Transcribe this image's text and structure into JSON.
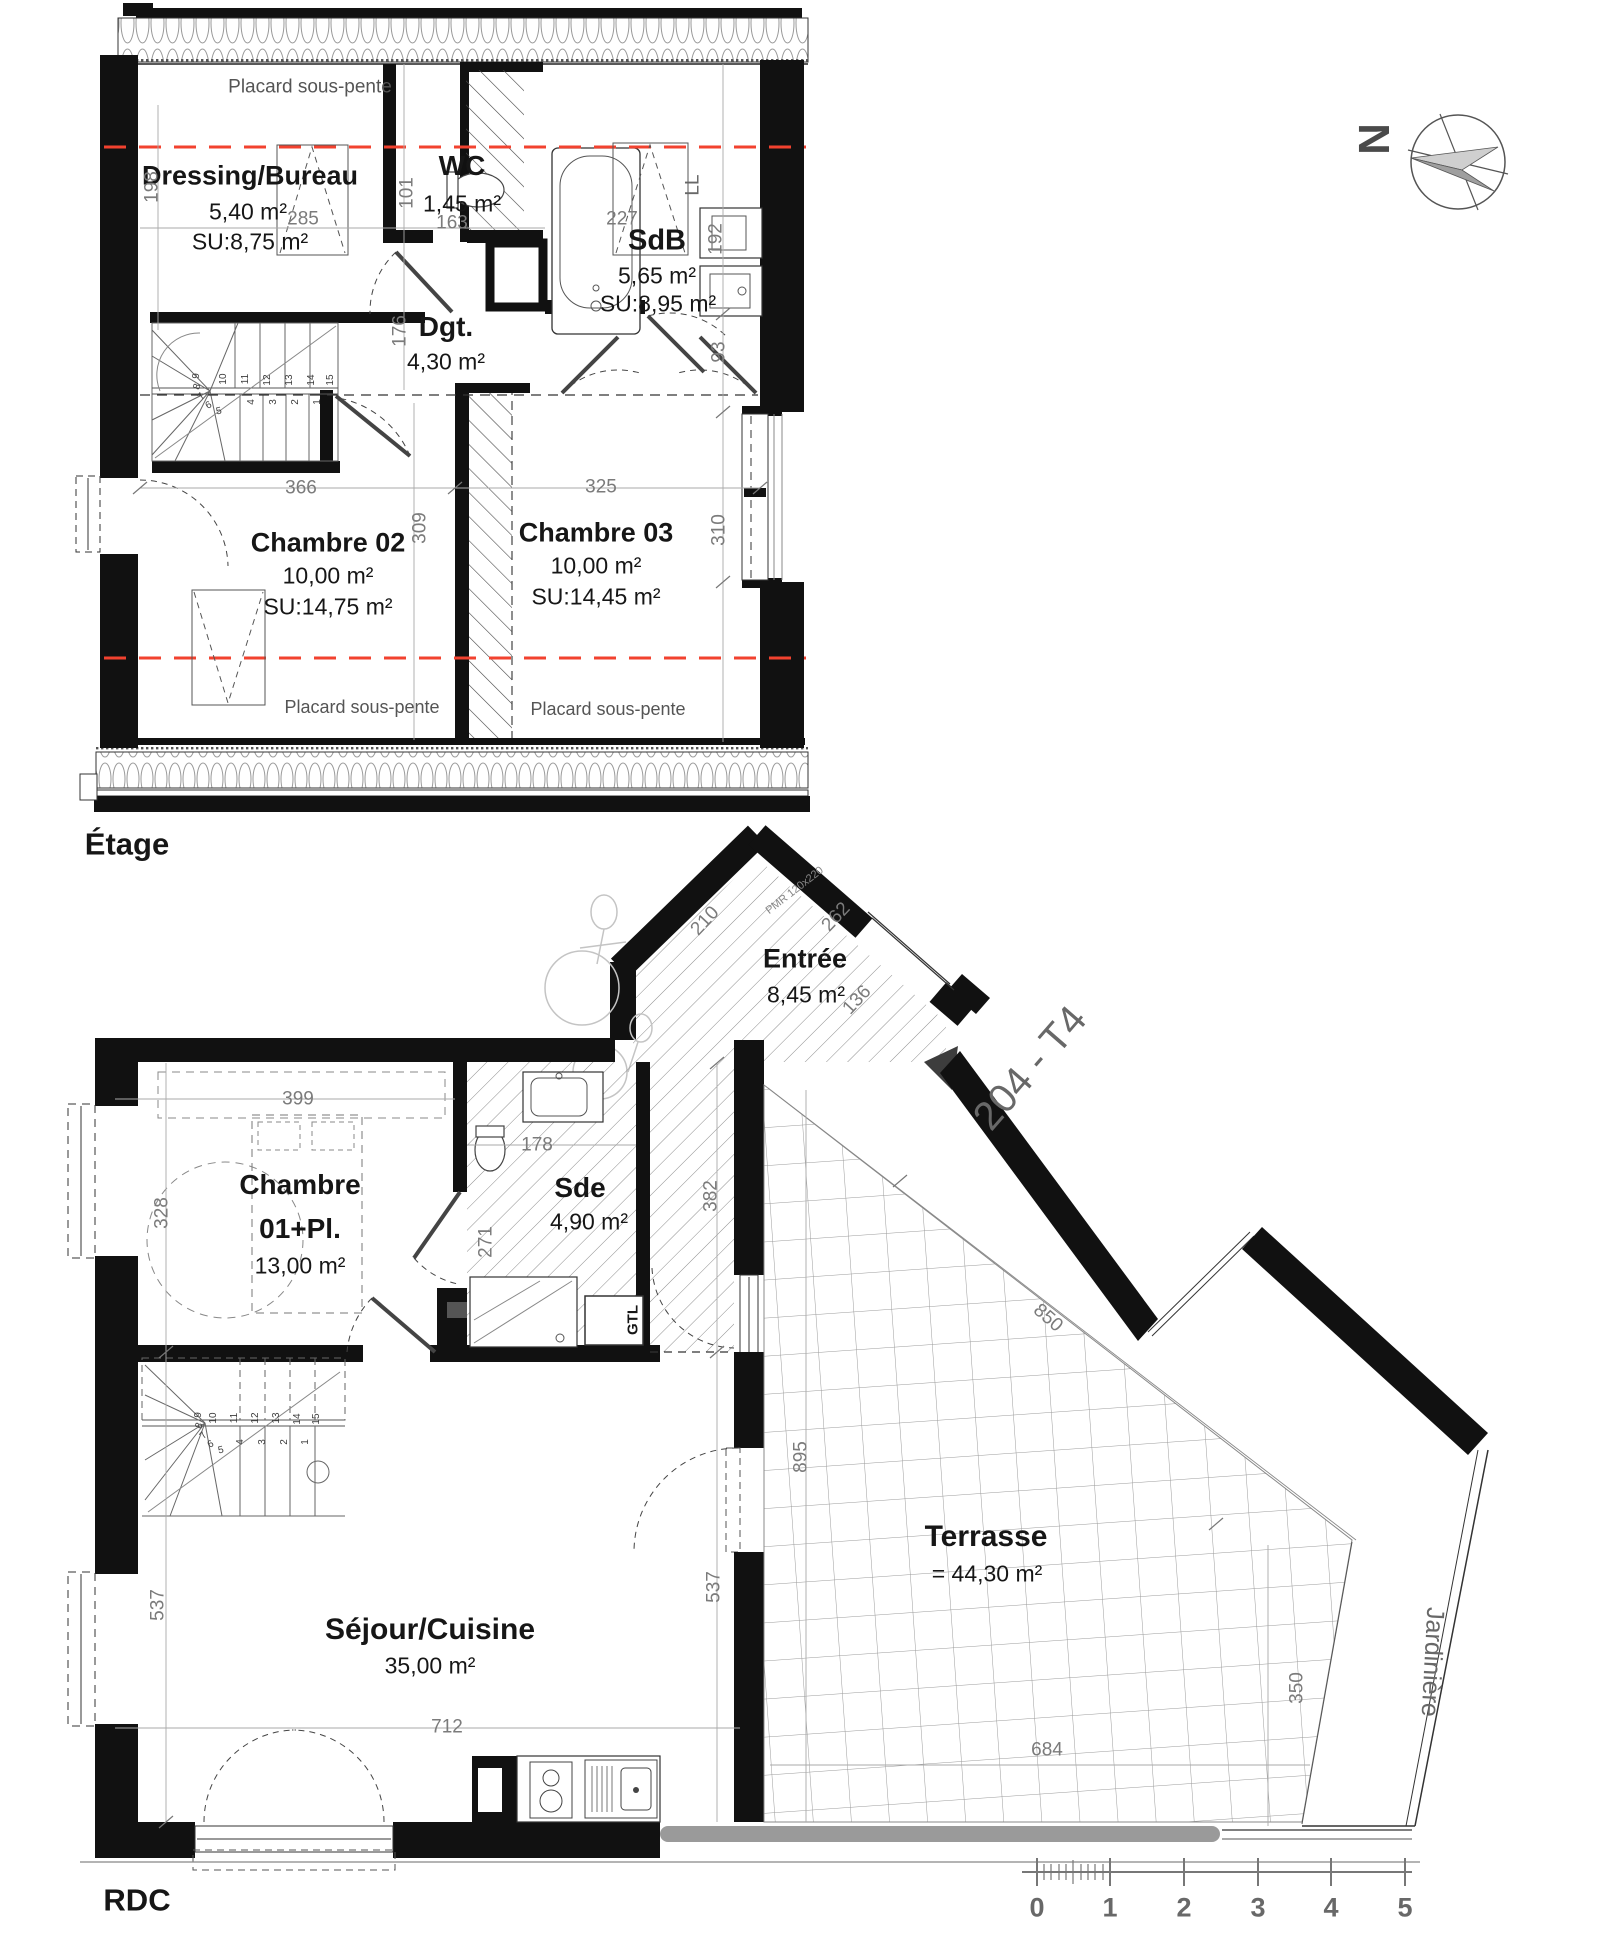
{
  "colors": {
    "wall": "#111111",
    "dim_gray": "#7b7b7b",
    "label_gray": "#686868",
    "red_line": "#f2422f",
    "terrace_bar": "#9a9a9a"
  },
  "compass": {
    "letter": "N"
  },
  "etage": {
    "floor_label": "Étage",
    "placard_top": "Placard sous-pente",
    "placard_bottom_left": "Placard sous-pente",
    "placard_bottom_right": "Placard sous-pente",
    "washer_label": "LL",
    "rooms": {
      "dressing": {
        "name": "Dressing/Bureau",
        "area": "5,40 m²",
        "su": "SU:8,75 m²"
      },
      "wc": {
        "name": "WC",
        "area": "1,45 m²"
      },
      "sdb": {
        "name": "SdB",
        "area": "5,65 m²",
        "su": "SU:8,95 m²"
      },
      "dgt": {
        "name": "Dgt.",
        "area": "4,30 m²"
      },
      "chambre02": {
        "name": "Chambre 02",
        "area": "10,00 m²",
        "su": "SU:14,75 m²"
      },
      "chambre03": {
        "name": "Chambre 03",
        "area": "10,00 m²",
        "su": "SU:14,45 m²"
      }
    }
  },
  "rdc": {
    "floor_label": "RDC",
    "unit_label": "204 - T4",
    "pmr_note": "PMR 120x220",
    "gtl_label": "GTL",
    "jardiniere_label": "Jardinière",
    "rooms": {
      "entree": {
        "name": "Entrée",
        "area": "8,45 m²"
      },
      "chambre01": {
        "line1": "Chambre",
        "line2": "01+Pl.",
        "area": "13,00 m²"
      },
      "sde": {
        "name": "Sde",
        "area": "4,90 m²"
      },
      "sejour": {
        "name": "Séjour/Cuisine",
        "area": "35,00 m²"
      },
      "terrasse": {
        "name": "Terrasse",
        "area": "= 44,30 m²"
      }
    }
  },
  "scalebar": {
    "labels": [
      "0",
      "1",
      "2",
      "3",
      "4",
      "5"
    ]
  },
  "dims": [
    {
      "t": "198",
      "x": 152,
      "y": 187,
      "r": -90
    },
    {
      "t": "285",
      "x": 303,
      "y": 219,
      "r": 0
    },
    {
      "t": "101",
      "x": 407,
      "y": 193,
      "r": -90
    },
    {
      "t": "163",
      "x": 452,
      "y": 223,
      "r": 0
    },
    {
      "t": "227",
      "x": 622,
      "y": 219,
      "r": 0
    },
    {
      "t": "192",
      "x": 716,
      "y": 239,
      "r": -90
    },
    {
      "t": "176",
      "x": 400,
      "y": 331,
      "r": -90
    },
    {
      "t": "93",
      "x": 719,
      "y": 352,
      "r": -90
    },
    {
      "t": "366",
      "x": 301,
      "y": 488,
      "r": 0
    },
    {
      "t": "309",
      "x": 420,
      "y": 528,
      "r": -90
    },
    {
      "t": "325",
      "x": 601,
      "y": 487,
      "r": 0
    },
    {
      "t": "310",
      "x": 719,
      "y": 530,
      "r": -90
    },
    {
      "t": "399",
      "x": 298,
      "y": 1099,
      "r": 0
    },
    {
      "t": "328",
      "x": 162,
      "y": 1213,
      "r": -90
    },
    {
      "t": "178",
      "x": 537,
      "y": 1145,
      "r": 0
    },
    {
      "t": "271",
      "x": 486,
      "y": 1242,
      "r": -90
    },
    {
      "t": "382",
      "x": 711,
      "y": 1196,
      "r": -90
    },
    {
      "t": "210",
      "x": 705,
      "y": 921,
      "r": -47
    },
    {
      "t": "262",
      "x": 836,
      "y": 917,
      "r": -47
    },
    {
      "t": "136",
      "x": 857,
      "y": 1000,
      "r": -47
    },
    {
      "t": "895",
      "x": 801,
      "y": 1457,
      "r": -90
    },
    {
      "t": "850",
      "x": 1048,
      "y": 1318,
      "r": 41
    },
    {
      "t": "537",
      "x": 158,
      "y": 1605,
      "r": -90
    },
    {
      "t": "537",
      "x": 714,
      "y": 1587,
      "r": -90
    },
    {
      "t": "712",
      "x": 447,
      "y": 1727,
      "r": 0
    },
    {
      "t": "684",
      "x": 1047,
      "y": 1750,
      "r": 0
    },
    {
      "t": "350",
      "x": 1297,
      "y": 1688,
      "r": -90
    }
  ],
  "stair_numbers": [
    {
      "t": "10",
      "x": 224,
      "y": 379,
      "r": -90
    },
    {
      "t": "11",
      "x": 246,
      "y": 379,
      "r": -90
    },
    {
      "t": "12",
      "x": 268,
      "y": 380,
      "r": -90
    },
    {
      "t": "13",
      "x": 290,
      "y": 380,
      "r": -90
    },
    {
      "t": "14",
      "x": 312,
      "y": 380,
      "r": -90
    },
    {
      "t": "15",
      "x": 331,
      "y": 380,
      "r": -90
    },
    {
      "t": "4",
      "x": 252,
      "y": 402,
      "r": -90
    },
    {
      "t": "3",
      "x": 274,
      "y": 402,
      "r": -90
    },
    {
      "t": "2",
      "x": 296,
      "y": 402,
      "r": -90
    },
    {
      "t": "1",
      "x": 318,
      "y": 402,
      "r": -90
    },
    {
      "t": "9",
      "x": 197,
      "y": 376,
      "r": -85
    },
    {
      "t": "8",
      "x": 198,
      "y": 387,
      "r": -70
    },
    {
      "t": "7",
      "x": 202,
      "y": 397,
      "r": -50
    },
    {
      "t": "6",
      "x": 209,
      "y": 406,
      "r": -30
    },
    {
      "t": "5",
      "x": 219,
      "y": 412,
      "r": -12
    },
    {
      "t": "10",
      "x": 214,
      "y": 1418,
      "r": -90
    },
    {
      "t": "11",
      "x": 235,
      "y": 1418,
      "r": -90
    },
    {
      "t": "12",
      "x": 256,
      "y": 1418,
      "r": -90
    },
    {
      "t": "13",
      "x": 277,
      "y": 1418,
      "r": -90
    },
    {
      "t": "14",
      "x": 298,
      "y": 1419,
      "r": -90
    },
    {
      "t": "15",
      "x": 317,
      "y": 1419,
      "r": -90
    },
    {
      "t": "4",
      "x": 241,
      "y": 1442,
      "r": -90
    },
    {
      "t": "3",
      "x": 263,
      "y": 1442,
      "r": -90
    },
    {
      "t": "2",
      "x": 285,
      "y": 1442,
      "r": -90
    },
    {
      "t": "1",
      "x": 306,
      "y": 1442,
      "r": -90
    },
    {
      "t": "9",
      "x": 199,
      "y": 1415,
      "r": -85
    },
    {
      "t": "8",
      "x": 200,
      "y": 1426,
      "r": -70
    },
    {
      "t": "7",
      "x": 204,
      "y": 1436,
      "r": -50
    },
    {
      "t": "6",
      "x": 211,
      "y": 1445,
      "r": -30
    },
    {
      "t": "5",
      "x": 221,
      "y": 1451,
      "r": -12
    }
  ]
}
